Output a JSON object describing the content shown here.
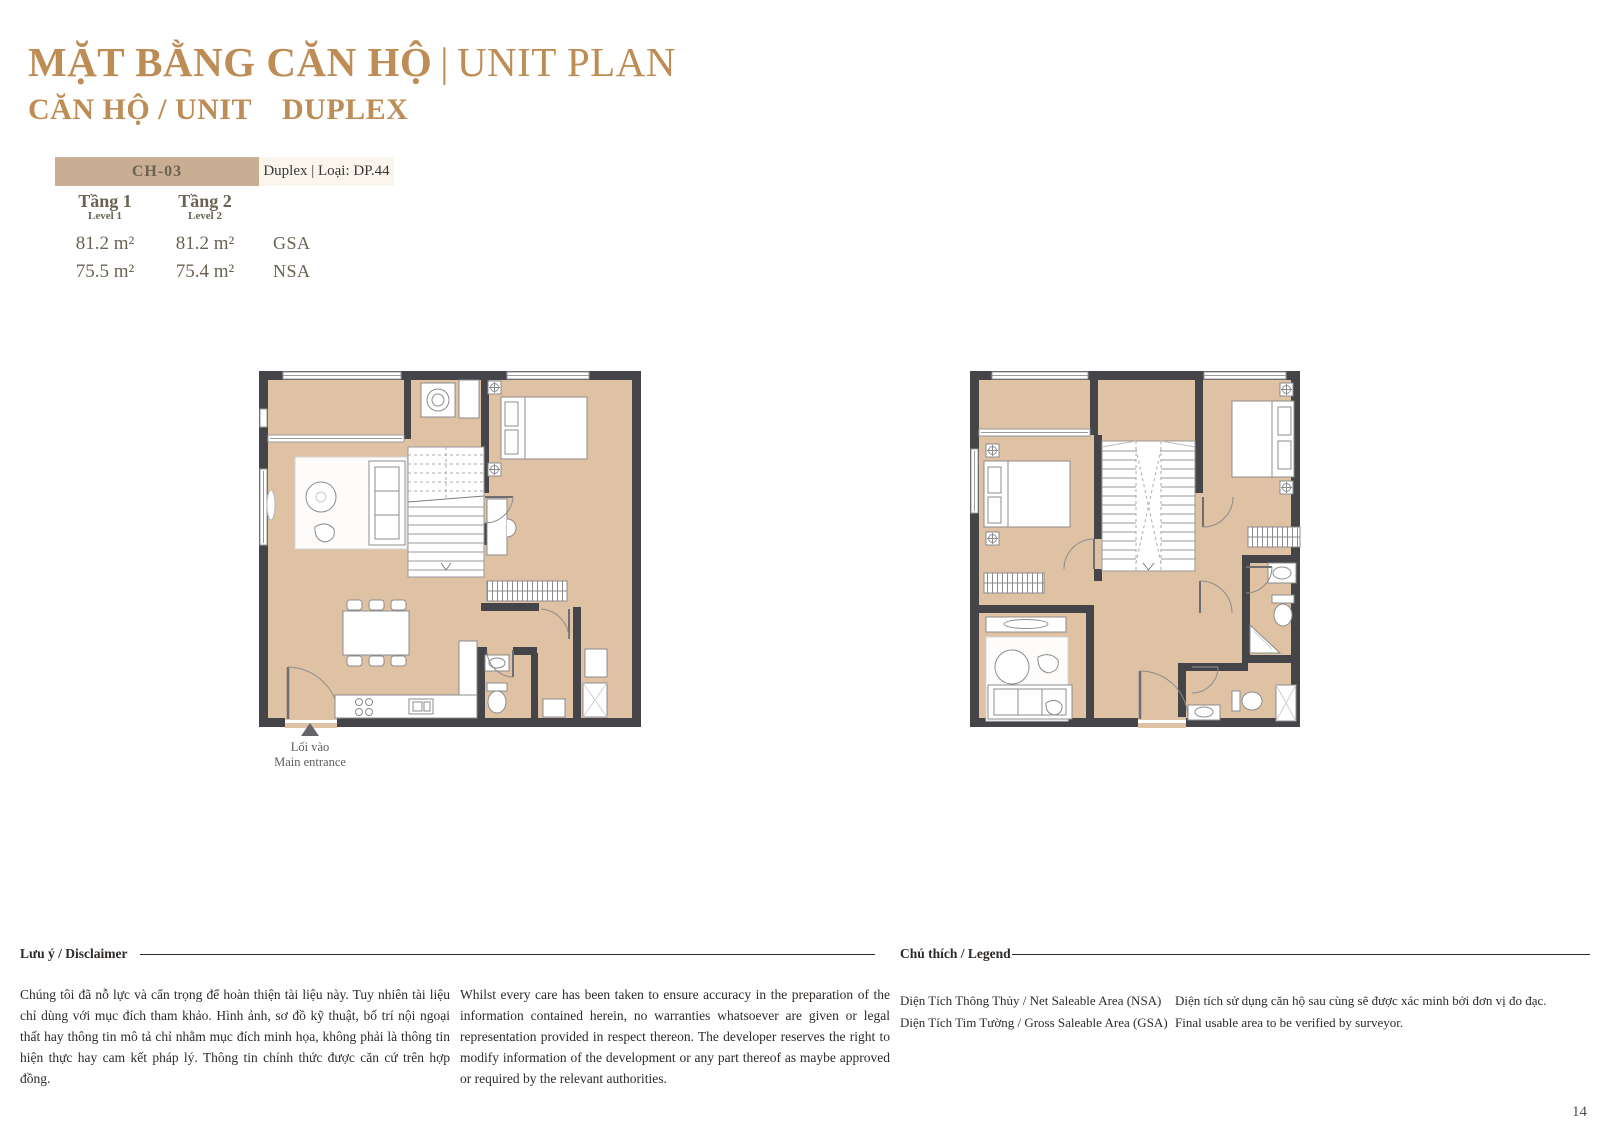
{
  "header": {
    "title_vi": "MẶT BẰNG CĂN HỘ",
    "title_sep": "|",
    "title_en": "UNIT PLAN",
    "subtitle_label": "CĂN HỘ / UNIT",
    "subtitle_value": "DUPLEX"
  },
  "unit_info": {
    "code": "CH-03",
    "type": "Duplex | Loại: DP.44",
    "levels": [
      {
        "label_vi": "Tầng 1",
        "label_en": "Level 1",
        "gsa": "81.2 m²",
        "nsa": "75.5 m²"
      },
      {
        "label_vi": "Tầng 2",
        "label_en": "Level 2",
        "gsa": "81.2 m²",
        "nsa": "75.4 m²"
      }
    ],
    "gsa_label": "GSA",
    "nsa_label": "NSA"
  },
  "plans": {
    "entrance_vi": "Lối vào",
    "entrance_en": "Main entrance"
  },
  "footer": {
    "disclaimer_heading": "Lưu ý / Disclaimer",
    "disclaimer_vi": "Chúng tôi đã nỗ lực và cẩn trọng để hoàn thiện tài liệu này. Tuy nhiên tài liệu chỉ dùng với mục đích tham khảo. Hình ảnh, sơ đồ kỹ thuật, bố trí nội ngoại thất hay thông tin mô tả chỉ nhằm mục đích minh họa, không phải là thông tin hiện thực hay cam kết pháp lý. Thông tin chính thức được căn cứ trên hợp đồng.",
    "disclaimer_en": "Whilst every care has been taken to ensure accuracy in the preparation of the information contained herein, no warranties whatsoever are given or legal representation provided in respect thereon. The developer reserves the right to modify information of the development or any part thereof as maybe approved or required by the relevant authorities.",
    "legend_heading": "Chú thích / Legend",
    "legend_left": [
      "Diện Tích Thông Thủy / Net Saleable Area (NSA)",
      "Diện Tích Tim Tường / Gross Saleable Area (GSA)"
    ],
    "legend_right": [
      "Diện tích sử dụng căn hộ sau cùng sẽ được xác minh bởi đơn vị đo đạc.",
      "Final usable area to be verified by surveyor."
    ],
    "page_number": "14"
  },
  "colors": {
    "gold": "#BE8C55",
    "header_tan": "#C9AE94",
    "header_cream": "#FAF6EE",
    "floor": "#DFC1A3",
    "wall": "#454549",
    "olive_text": "#6A6352"
  }
}
